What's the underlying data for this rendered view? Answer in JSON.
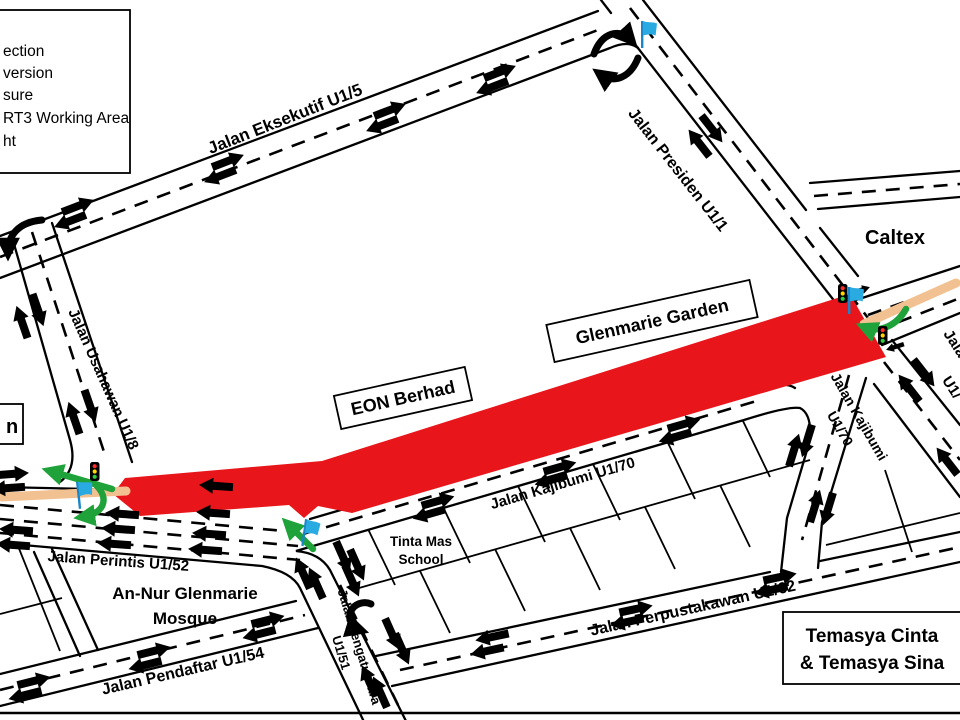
{
  "legend": {
    "items": [
      "ection",
      "version",
      "sure",
      "RT3 Working Area",
      "ht"
    ]
  },
  "labels": {
    "eksekutif": "Jalan Eksekutif U1/5",
    "presiden": "Jalan Presiden U1/1",
    "caltex": "Caltex",
    "glenmarie_garden": "Glenmarie Garden",
    "eon": "EON Berhad",
    "usahawan": "Jalan Usahawan U1/8",
    "kajibumi_ew": "Jalan Kajibumi U1/70",
    "kajibumi_ns_1": "Jalan Kajibumi",
    "kajibumi_ns_2": "U1/70",
    "edge_partial_1": "Jala",
    "edge_partial_2": "U1/",
    "tinta_1": "Tinta Mas",
    "tinta_2": "School",
    "perintis": "Jalan Perintis U1/52",
    "mosque_1": "An-Nur Glenmarie",
    "mosque_2": "Mosque",
    "pendaftar": "Jalan Pendaftar U1/54",
    "pengaturcara_1": "Jalan Pengaturcara",
    "pengaturcara_2": "U1/51",
    "perpustakawan": "Jalan Perpustakawan U1/62",
    "temasya_1": "Temasya Cinta",
    "temasya_2": "& Temasya Sina",
    "partial_left": "n"
  },
  "colors": {
    "closure_red": "#E8151B",
    "diversion_green": "#1FA23A",
    "flag_blue": "#29ABE2",
    "working_area_orange": "#F2C191",
    "road_black": "#000000"
  }
}
